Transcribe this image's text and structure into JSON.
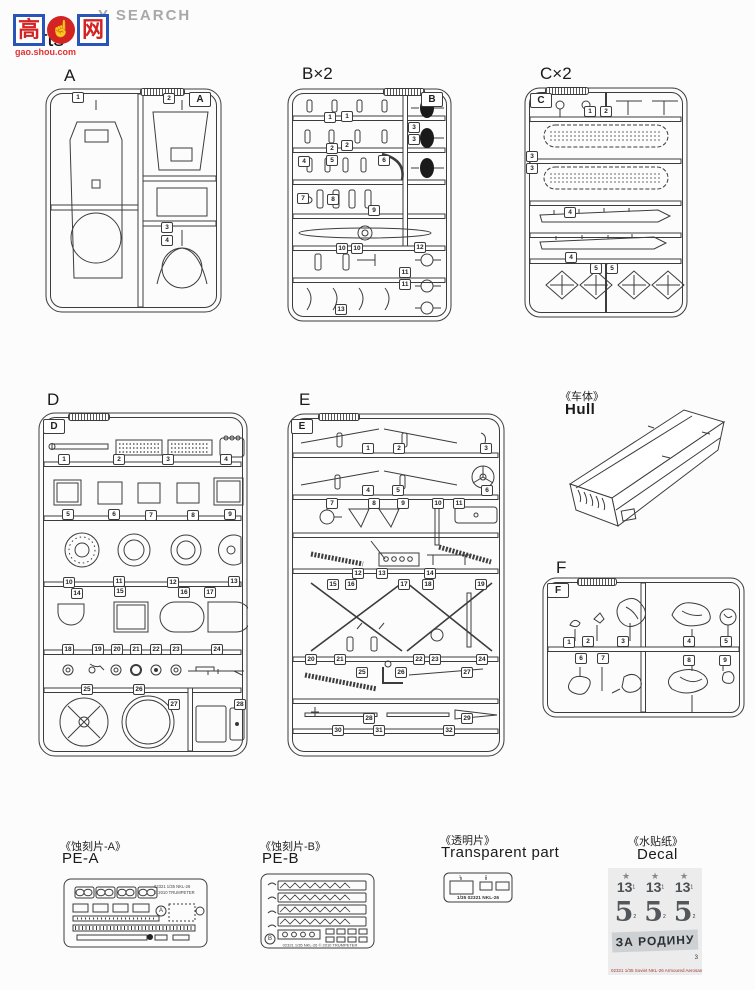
{
  "watermark": {
    "search_text": "Y SEARCH",
    "logo_char_left": "高",
    "logo_char_right": "网",
    "thumb_icon": "☝",
    "url": "gao.shou.com"
  },
  "page_title": "Parts",
  "sprues": {
    "A": {
      "label": "A",
      "corner": "A",
      "parts": [
        "1",
        "2",
        "3",
        "4"
      ]
    },
    "B": {
      "label": "B×2",
      "corner": "B",
      "parts": [
        "1",
        "1",
        "2",
        "2",
        "3",
        "3",
        "4",
        "5",
        "6",
        "7",
        "8",
        "9",
        "10",
        "10",
        "11",
        "11",
        "12",
        "13"
      ]
    },
    "C": {
      "label": "C×2",
      "corner": "C",
      "parts": [
        "1",
        "2",
        "3",
        "3",
        "4",
        "4",
        "5",
        "5"
      ]
    },
    "D": {
      "label": "D",
      "corner": "D",
      "parts": [
        "1",
        "2",
        "3",
        "4",
        "5",
        "6",
        "7",
        "8",
        "9",
        "10",
        "11",
        "12",
        "13",
        "14",
        "15",
        "16",
        "17",
        "18",
        "19",
        "20",
        "21",
        "22",
        "23",
        "24",
        "25",
        "26",
        "27",
        "28"
      ]
    },
    "E": {
      "label": "E",
      "corner": "E",
      "parts": [
        "1",
        "2",
        "3",
        "4",
        "5",
        "6",
        "7",
        "8",
        "9",
        "10",
        "11",
        "12",
        "13",
        "14",
        "15",
        "16",
        "17",
        "18",
        "19",
        "20",
        "21",
        "22",
        "23",
        "24",
        "25",
        "26",
        "27",
        "28",
        "29",
        "30",
        "31",
        "32"
      ]
    },
    "F": {
      "label": "F",
      "corner": "F",
      "parts": [
        "1",
        "2",
        "3",
        "4",
        "5",
        "6",
        "7",
        "8",
        "9"
      ]
    }
  },
  "hull": {
    "title_zh": "《车体》",
    "title_en": "Hull"
  },
  "pe_a": {
    "title_zh": "《蚀刻片-A》",
    "title_en": "PE-A",
    "fret_letter": "A",
    "fret_text_line1": "02321 1/35 NKL-26",
    "fret_text_line2": "© 2010 TRUMPETER"
  },
  "pe_b": {
    "title_zh": "《蚀刻片-B》",
    "title_en": "PE-B",
    "fret_letter": "B",
    "fret_text": "02321 1/35 NKL-26 © 2010 TRUMPETER"
  },
  "transparent": {
    "title_zh": "《透明片》",
    "title_en": "Transparent part",
    "part_markers": [
      "1",
      "2"
    ],
    "sprue_text": "1/35 02321 NKL-26"
  },
  "decal": {
    "title_zh": "《水贴纸》",
    "title_en": "Decal",
    "star_icon": "★",
    "number_13": "13",
    "number_5": "5",
    "slogan": "ЗА РОДИНУ",
    "marker_1": "1",
    "marker_2": "2",
    "marker_3": "3",
    "bottom_text": "02321 1/35 Soviet NKL-26 Armoured Aerosan"
  }
}
